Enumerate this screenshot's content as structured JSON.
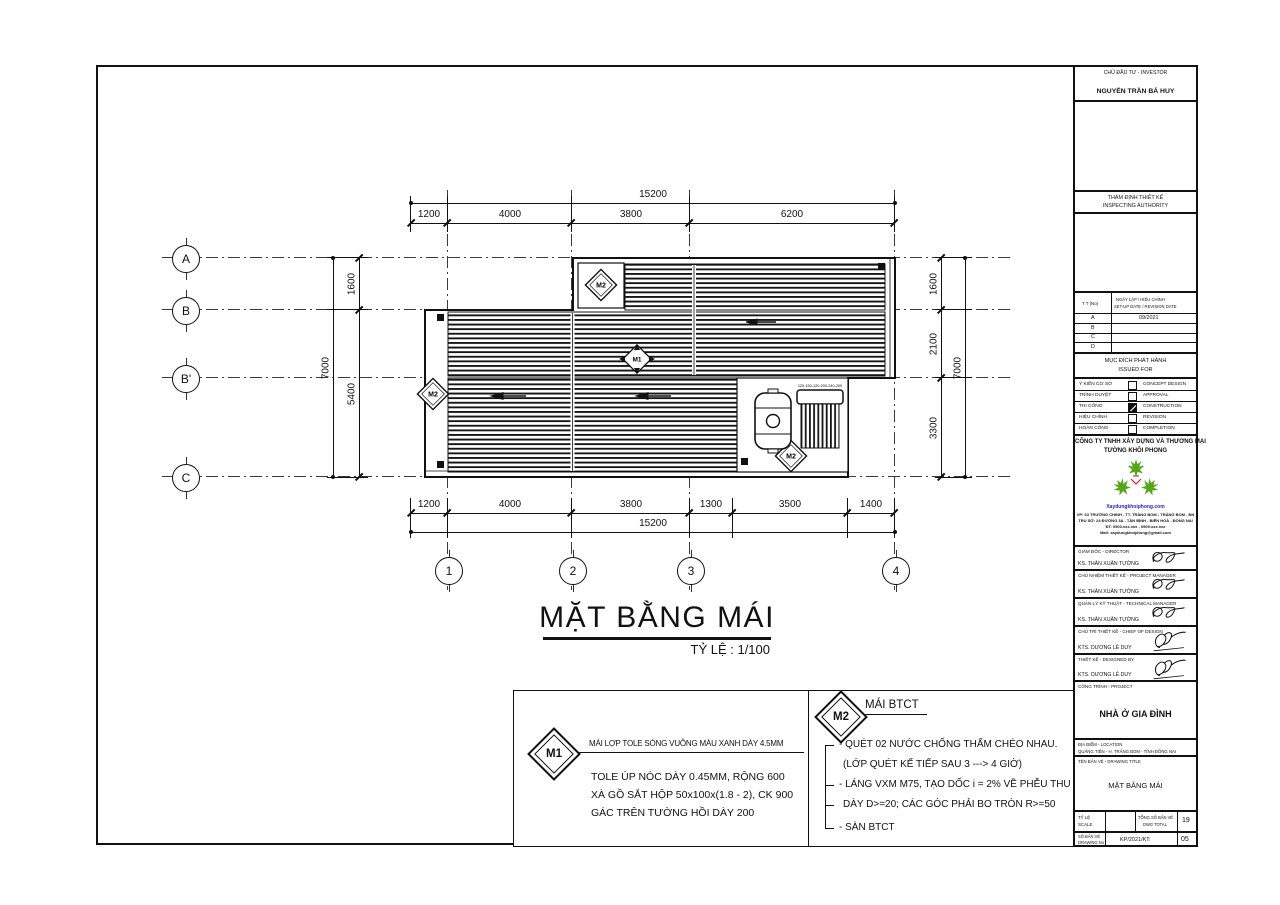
{
  "plan": {
    "title": "MẶT BẰNG MÁI",
    "scale_label": "TỶ LỆ : 1/100",
    "grid_rows": [
      "A",
      "B",
      "B'",
      "C"
    ],
    "grid_cols": [
      "1",
      "2",
      "3",
      "4"
    ],
    "dims": {
      "top_total": "15200",
      "top_segments": [
        "1200",
        "4000",
        "3800",
        "6200"
      ],
      "bottom_segments": [
        "1200",
        "4000",
        "3800",
        "1300",
        "3500",
        "1400"
      ],
      "bottom_total": "15200",
      "left_total": "7000",
      "left_segments": [
        "1600",
        "5400"
      ],
      "right_segments": [
        "1600",
        "2100",
        "3300"
      ],
      "right_total": "7000"
    },
    "markers": {
      "m1": "M1",
      "m2": "M2"
    },
    "solar_label": "120-150-120-200-240-200"
  },
  "notes": {
    "m1": {
      "tag": "M1",
      "headline": "MÁI LỢP TOLE SÓNG VUÔNG MÀU XANH DÀY 4.5MM",
      "lines": [
        "TOLE  ÚP NÓC DÀY 0.45MM, RỘNG  600",
        "XÀ GỒ SẮT HỘP 50x100x(1.8 - 2), CK 900",
        "GÁC TRÊN TƯỜNG HỒI DÀY 200"
      ]
    },
    "m2": {
      "tag": "M2",
      "headline": "MÁI BTCT",
      "lines": [
        "- QUÉT 02 NƯỚC CHỐNG THẤM CHÉO NHAU.",
        "(LỚP QUÉT KẾ TIẾP SAU 3 ---> 4 GIỜ)",
        "- LÁNG VXM M75, TẠO DỐC i = 2% VỀ PHỄU THU",
        "DÀY D>=20; CÁC GÓC PHẢI BO TRÒN R>=50",
        "- SÀN BTCT"
      ]
    }
  },
  "titleblock": {
    "investor_label": "CHỦ ĐẦU TƯ - INVESTOR",
    "investor_name": "NGUYỄN TRẦN BÁ HUY",
    "inspecting_line1": "THẨM ĐỊNH THIẾT KẾ",
    "inspecting_line2": "INSPECTING AUTHORITY",
    "revision": {
      "col1": "T T (No)",
      "col2_line1": "NGÀY LẬP / HIỆU CHỈNH",
      "col2_line2": "SET-UP DATE / REVISION DATE",
      "rows": [
        {
          "no": "A",
          "date": "09/2021"
        },
        {
          "no": "B",
          "date": ""
        },
        {
          "no": "C",
          "date": ""
        },
        {
          "no": "D",
          "date": ""
        }
      ]
    },
    "issued_for": {
      "title_vi": "MỤC ĐÍCH PHÁT HÀNH",
      "title_en": "ISSUED FOR",
      "rows": [
        {
          "vi": "Ý KIẾN CƠ SỞ",
          "en": "CONCEPT DESIGN",
          "checked": false
        },
        {
          "vi": "TRÌNH DUYỆT",
          "en": "APPROVAL",
          "checked": false
        },
        {
          "vi": "THI CÔNG",
          "en": "CONSTRUCTION",
          "checked": true
        },
        {
          "vi": "HIỆU CHỈNH",
          "en": "REVISION",
          "checked": false
        },
        {
          "vi": "HOÀN CÔNG",
          "en": "COMPLETION",
          "checked": false
        }
      ]
    },
    "company": {
      "name_line1": "CÔNG TY TNHH XÂY DỰNG VÀ THƯƠNG MẠI",
      "name_line2": "TƯỜNG KHÔI PHONG",
      "website": "Xaydungkhoiphong.com",
      "website_color": "#2222cc",
      "logo_green": "#55a61b",
      "logo_red": "#cc2233",
      "address_lines": [
        "VP: 63 TRƯỜNG CHINH - TT. TRẢNG BOM - TRẢNG BOM - ĐN",
        "TRỤ SỞ: 24 ĐƯỜNG 3A - TÂN BÌNH - BIÊN HOÀ - ĐỒNG NAI",
        "ĐT: 0903.xxx.xxx - 0909.xxx.xxx",
        "Mail: xaydungkhoiphong@gmail.com"
      ]
    },
    "personnel": [
      {
        "role": "GIÁM ĐỐC - DIRECTOR",
        "name": "KS. THÂN XUÂN TƯỜNG"
      },
      {
        "role": "CHỦ NHIỆM THIẾT KẾ - PROJECT MANAGER",
        "name": "KS. THÂN XUÂN TƯỜNG"
      },
      {
        "role": "QUẢN LÝ KỸ THUẬT - TECHNICAL MANAGER",
        "name": "KS. THÂN XUÂN TƯỜNG"
      },
      {
        "role": "CHỦ TRÌ THIẾT KẾ - CHIEF OF DESIGN",
        "name": "KTS. DƯƠNG LÊ DUY"
      },
      {
        "role": "THIẾT KẾ - DESIGNED BY",
        "name": "KTS. DƯƠNG LÊ DUY"
      }
    ],
    "project_label": "CÔNG TRÌNH - PROJECT",
    "project_name": "NHÀ Ở GIA ĐÌNH",
    "location_label": "ĐỊA ĐIỂM - LOCATION",
    "location_value": "QUẢNG TIẾN - H. TRẢNG BOM - TỈNH ĐỒNG NAI",
    "drawing_title_label": "TÊN BẢN VẼ - DRAWING TITLE",
    "drawing_title_value": "MẶT BẰNG MÁI",
    "scale_label_vi": "TỶ LỆ",
    "scale_label_en": "SCALE",
    "scale_value": "",
    "total_label_vi": "TỔNG SỐ BẢN VẼ",
    "total_label_en": "DWG TOTAL",
    "total_value": "19",
    "number_label_vi": "SỐ BẢN VẼ",
    "number_label_en": "DRAWING No",
    "number_code": "KP/2021/KT:",
    "number_value": "05"
  }
}
